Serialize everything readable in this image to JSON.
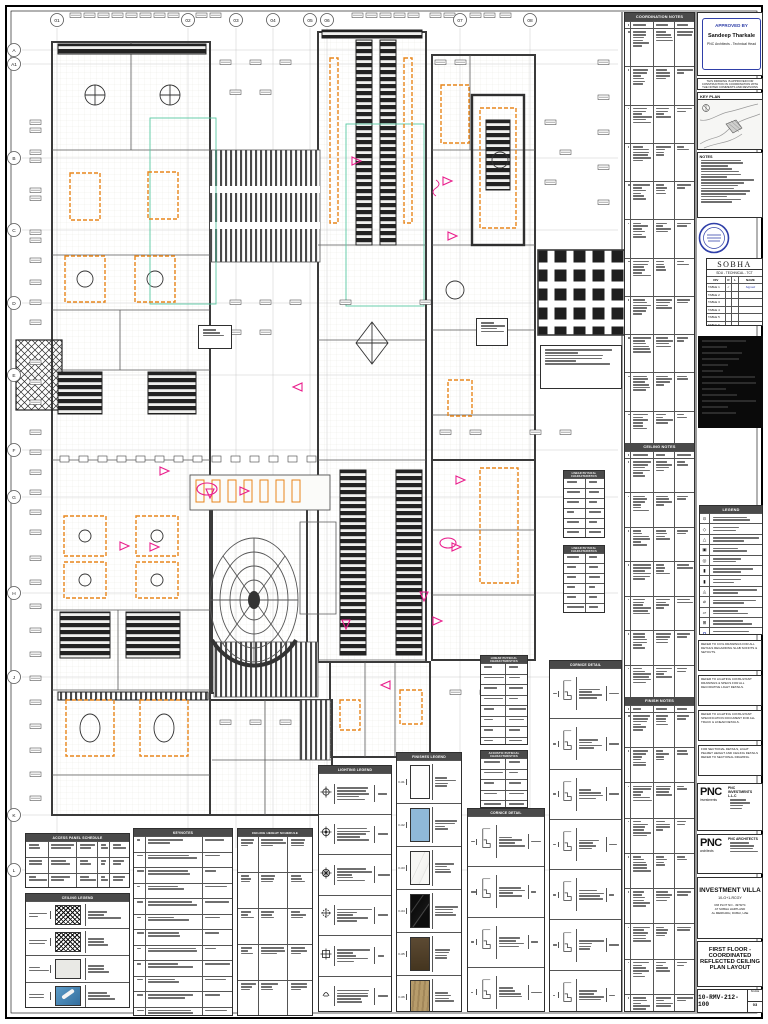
{
  "sheet": {
    "accent_orange": "#E8861B",
    "accent_magenta": "#E91E8C",
    "accent_green": "#58C9A2",
    "accent_blue": "#2F3FA8"
  },
  "grid": {
    "top": [
      "01",
      "02",
      "03",
      "04",
      "05",
      "06",
      "07",
      "08"
    ],
    "side": [
      "A",
      "A1",
      "B",
      "C",
      "D",
      "E",
      "F",
      "G",
      "H",
      "J",
      "K",
      "L"
    ]
  },
  "right_col": {
    "approval": {
      "label": "APPROVED BY",
      "name": "Sandeep Tharkale",
      "role": "PNC Architects - Technical Head",
      "note": "THIS DRAWING IS APPROVED FOR CONSTRUCTION IN COORDINATION WITH THE NOTED COMMENTS AND REVISIONS"
    },
    "key_plan_title": "KEY PLAN",
    "notes_title": "NOTES",
    "sobha": {
      "brand": "SOBHA",
      "dept": "SDU - TECHNICAL - TCT",
      "cols": [
        "DIV",
        "R",
        "L",
        "NAME"
      ],
      "rows": [
        "TABLE 1",
        "TABLE 2",
        "TABLE 3",
        "TABLE 4",
        "TABLE 5",
        "TABLE 6"
      ],
      "check": "✓",
      "signed": "Signed"
    },
    "legend_title": "LEGEND",
    "note_boxes": [
      "REFER TO CIVIL DRAWINGS FOR ALL DETAILS REGARDING SLAB SOFFITS & SETOUTS.",
      "REFER TO LIGHTING CONSULTANT DRAWINGS & SPECS FOR ALL DECORATIVE LIGHT DETAILS.",
      "REFER TO LIGHTING CONSULTANT SPECIFICATION DOCUMENT FOR ALL TRACK & LINEAR DETAILS.",
      "FOR SECTIONAL DETAILS, LIGHT PELMET HEIGHT AND CEILING DETAILS REFER TO SECTIONAL DRAWING."
    ],
    "pnc_inv": {
      "logo": "PNC",
      "tag": "investments",
      "name": "PNC INVESTMENTS L.L.C"
    },
    "pnc_arch": {
      "logo": "PNC",
      "tag": "architects",
      "name": "PNC ARCHITECTS"
    },
    "project": {
      "name": "INVESTMENT VILLA",
      "code": "10-G+1-RCGY",
      "addr": [
        "RM PLOT NO - 4979/74",
        "AT SOBHA HARTLAND",
        "AL MERKADH, DUBAI, UAE"
      ]
    },
    "sheet_title_lines": [
      "FIRST FLOOR -",
      "COORDINATED",
      "REFLECTED CEILING",
      "PLAN LAYOUT"
    ],
    "sheet_no": "10-RMV-212-100",
    "rev": "03",
    "scale_label": "SCALE"
  },
  "mid_table": {
    "cols": [
      "NO",
      "DESCRIPTION",
      "STATUS",
      "REM"
    ],
    "sections": [
      {
        "title": "COORDINATION NOTES",
        "rows": 11
      },
      {
        "title": "CEILING NOTES",
        "rows": 7
      },
      {
        "title": "FINISH NOTES",
        "rows": 9
      }
    ]
  },
  "legends": {
    "access": {
      "title": "ACCESS PANEL SCHEDULE"
    },
    "ceiling": {
      "title": "CEILING LEGEND"
    },
    "keynotes": {
      "title": "KEYNOTES"
    },
    "heights": {
      "title": "CEILING HEIGHT SCHEDULE"
    },
    "lighting": {
      "title": "LIGHTING LEGEND"
    },
    "finishes": {
      "title": "FINISHES LEGEND",
      "codes": [
        "F-01",
        "F-02",
        "F-03",
        "F-04",
        "F-05",
        "F-06"
      ]
    },
    "cornice_a": {
      "title": "CORNICE DETAIL"
    },
    "cornice_b": {
      "title": "CORNICE DETAIL"
    },
    "linear": {
      "title": "LINEAR PHYSICAL CHARACTERISTICS"
    },
    "acoustic": {
      "title": "ACOUSTIC PHYSICAL CHARACTERISTICS"
    }
  }
}
